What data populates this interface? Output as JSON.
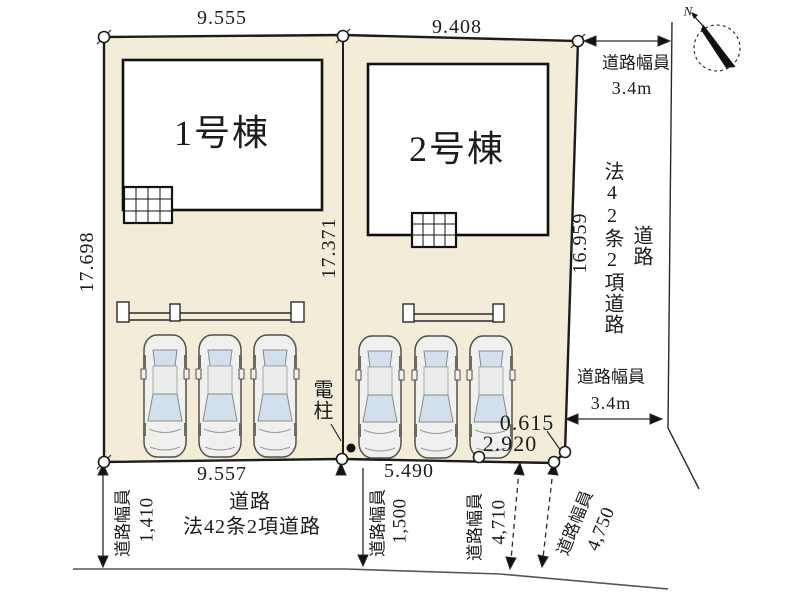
{
  "colors": {
    "lot_fill": "#f2ecd9",
    "building_fill": "#ffffff",
    "line": "#1c1c1c",
    "car_body": "#f0f1ef",
    "car_window": "#d2e0ee"
  },
  "buildings": {
    "b1": "1号棟",
    "b2": "2号棟"
  },
  "dims": {
    "top_left": "9.555",
    "top_right": "9.408",
    "left": "17.698",
    "center": "17.371",
    "right": "16.959",
    "bottom_left": "9.557",
    "bottom_mid": "5.490",
    "corner_short": "0.615",
    "corner_long": "2.920"
  },
  "road_width": {
    "label": "道路幅員",
    "top_right_value": "3.4m",
    "right_value": "3.4m",
    "w_1410": "1,410",
    "w_1500": "1,500",
    "w_4710": "4,710",
    "w_4750": "4,750"
  },
  "roads": {
    "name_line1": "道路",
    "name_line2": "法42条2項道路"
  },
  "pole": {
    "label": "電柱"
  },
  "compass": {
    "label": "N"
  },
  "icons": {
    "north_arrow": "north-arrow-icon",
    "utility_pole": "utility-pole-icon",
    "car": "car-icon",
    "survey_point": "survey-point-icon",
    "terrace_grid": "terrace-grid-icon"
  }
}
